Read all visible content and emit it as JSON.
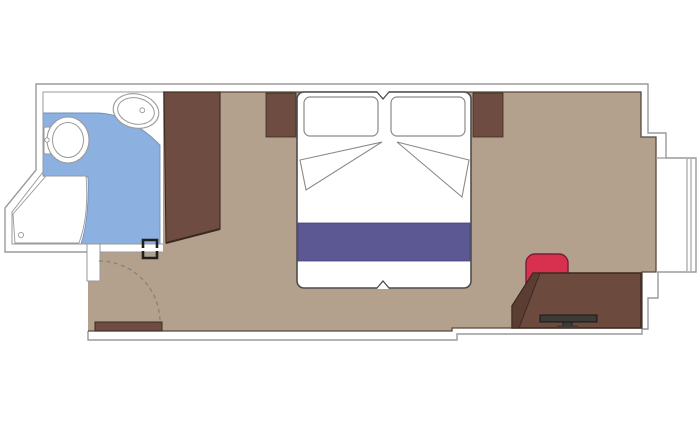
{
  "canvas": {
    "width": 700,
    "height": 433,
    "background": "#ffffff"
  },
  "colors": {
    "wall_outline": "#9a9a9a",
    "interior_edge": "#57493e",
    "floor": "#b3a18e",
    "bathroom_floor": "#8cb0e0",
    "bathroom_floor_edge": "#7291b8",
    "fixture_outline": "#9a9a9a",
    "wood": "#6e4c42",
    "wood_dark_edge": "#3b2a20",
    "desk": "#6d4a3e",
    "desk_shade": "#5b3d32",
    "bed_outline": "#4d4d4d",
    "pillow_outline": "#8a8a8a",
    "bed_runner": "#5b5894",
    "runner_edge": "#44427a",
    "chair": "#d8304f",
    "chair_outline": "#7e1d35",
    "tv": "#3d3b38",
    "tv_outline": "#161616",
    "door_swing": "#8f7f70",
    "hardware": "#1f1f1f",
    "white": "#ffffff"
  },
  "plan": {
    "type": "cruise-cabin-floor-plan",
    "rooms": [
      {
        "name": "bathroom",
        "floor": "blue",
        "fixtures": [
          "toilet",
          "sink",
          "shower"
        ]
      },
      {
        "name": "cabin",
        "floor": "tan",
        "furniture": [
          "wardrobe",
          "nightstand-left",
          "nightstand-right",
          "double-bed",
          "pillow-left",
          "pillow-right",
          "bed-runner",
          "desk",
          "tv",
          "chair",
          "entry-door-leaf"
        ]
      }
    ],
    "features": [
      "entry-door-swing",
      "window-bay"
    ]
  }
}
